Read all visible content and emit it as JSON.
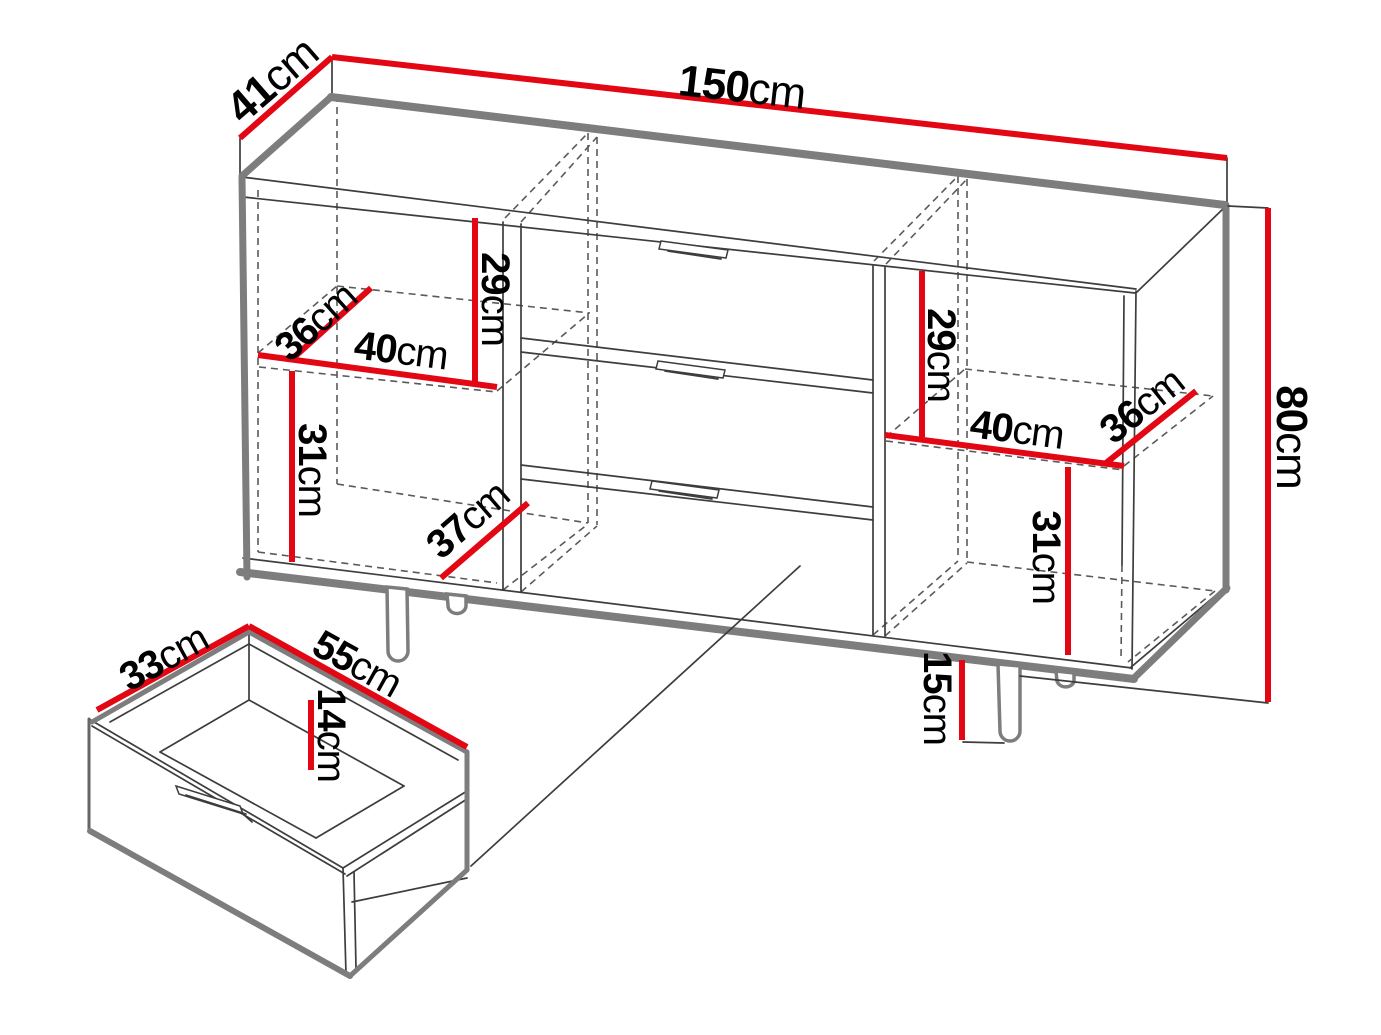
{
  "colors": {
    "dimension_red": "#e30613",
    "edge_thick": "#7d7d7d",
    "edge_thin": "#3d3d3d",
    "edge_dashed": "#5a5a5a",
    "leg_outline": "#7d7d7d",
    "label_text": "#000000",
    "background": "#ffffff"
  },
  "labels": {
    "top_depth": {
      "value": "41",
      "unit": "cm"
    },
    "top_width": {
      "value": "150",
      "unit": "cm"
    },
    "height": {
      "value": "80",
      "unit": "cm"
    },
    "left_upper_height": {
      "value": "29",
      "unit": "cm"
    },
    "left_shelf_depth": {
      "value": "36",
      "unit": "cm"
    },
    "left_shelf_width": {
      "value": "40",
      "unit": "cm"
    },
    "left_lower_height": {
      "value": "31",
      "unit": "cm"
    },
    "left_bottom_depth": {
      "value": "37",
      "unit": "cm"
    },
    "right_upper_height": {
      "value": "29",
      "unit": "cm"
    },
    "right_shelf_width": {
      "value": "40",
      "unit": "cm"
    },
    "right_shelf_depth": {
      "value": "36",
      "unit": "cm"
    },
    "right_lower_height": {
      "value": "31",
      "unit": "cm"
    },
    "leg_height": {
      "value": "15",
      "unit": "cm"
    },
    "drawer_depth": {
      "value": "33",
      "unit": "cm"
    },
    "drawer_width": {
      "value": "55",
      "unit": "cm"
    },
    "drawer_height": {
      "value": "14",
      "unit": "cm"
    }
  }
}
